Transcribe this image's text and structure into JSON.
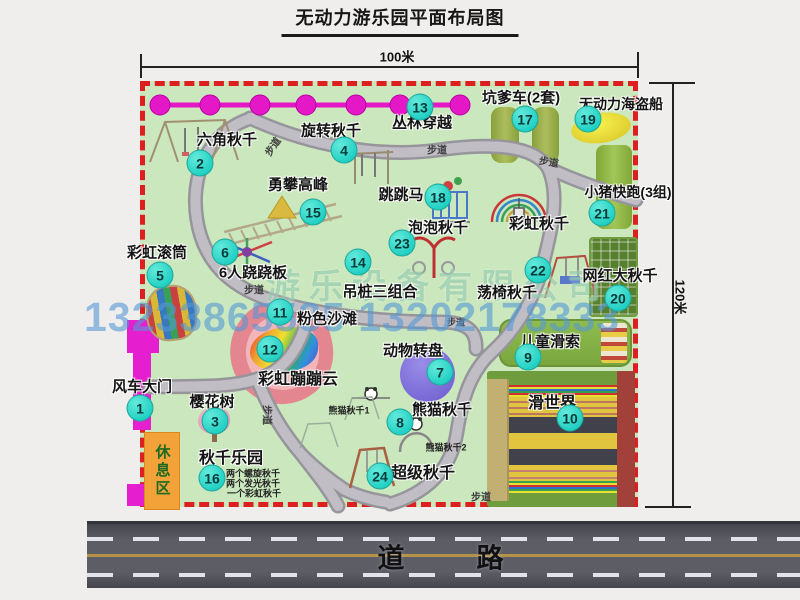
{
  "title": "无动力游乐园平面布局图",
  "dimensions": {
    "width_label": "100米",
    "height_label": "120米"
  },
  "road": {
    "label": "道　　路"
  },
  "watermark": {
    "company": "游乐设备有限公司",
    "phone": "13233865535 13202178333"
  },
  "footpath": "步道",
  "attractions": [
    {
      "num": "1",
      "label": "风车大门"
    },
    {
      "num": "2",
      "label": "六角秋千"
    },
    {
      "num": "3",
      "label": "樱花树"
    },
    {
      "num": "4",
      "label": "旋转秋千"
    },
    {
      "num": "5",
      "label": "彩虹滚筒"
    },
    {
      "num": "6",
      "label": "6人跷跷板"
    },
    {
      "num": "7",
      "label": "动物转盘"
    },
    {
      "num": "8",
      "label": "熊猫秋千"
    },
    {
      "num": "9",
      "label": "儿童滑索"
    },
    {
      "num": "10",
      "label": "滑世界"
    },
    {
      "num": "11",
      "label": "粉色沙滩"
    },
    {
      "num": "12",
      "label": "彩虹蹦蹦云"
    },
    {
      "num": "13",
      "label": "丛林穿越"
    },
    {
      "num": "14",
      "label": "吊桩三组合"
    },
    {
      "num": "15",
      "label": "勇攀高峰"
    },
    {
      "num": "16",
      "label": "秋千乐园"
    },
    {
      "num": "17",
      "label": "坑爹车(2套)"
    },
    {
      "num": "18",
      "label": "跳跳马"
    },
    {
      "num": "19",
      "label": "无动力海盗船"
    },
    {
      "num": "20",
      "label": "网红大秋千"
    },
    {
      "num": "21",
      "label": "小猪快跑(3组)"
    },
    {
      "num": "22",
      "label": "荡椅秋千"
    },
    {
      "num": "23",
      "label": "泡泡秋千"
    },
    {
      "num": "24",
      "label": "超级秋千"
    }
  ],
  "unnumbered": {
    "rainbow_swing": "彩虹秋千",
    "rest_area": "休息区",
    "panda_swing_1": "熊猫秋千1",
    "panda_swing_2": "熊猫秋千2"
  },
  "swing_park_notes": [
    "两个螺旋秋千",
    "两个发光秋千",
    "一个彩虹秋千"
  ],
  "colors": {
    "park_green": "#cbe7bd",
    "border_red": "#dd1f1f",
    "badge_cyan": "#2fdccf",
    "gate_magenta": "#e51fd0",
    "road_gray": "#5d5d66"
  }
}
